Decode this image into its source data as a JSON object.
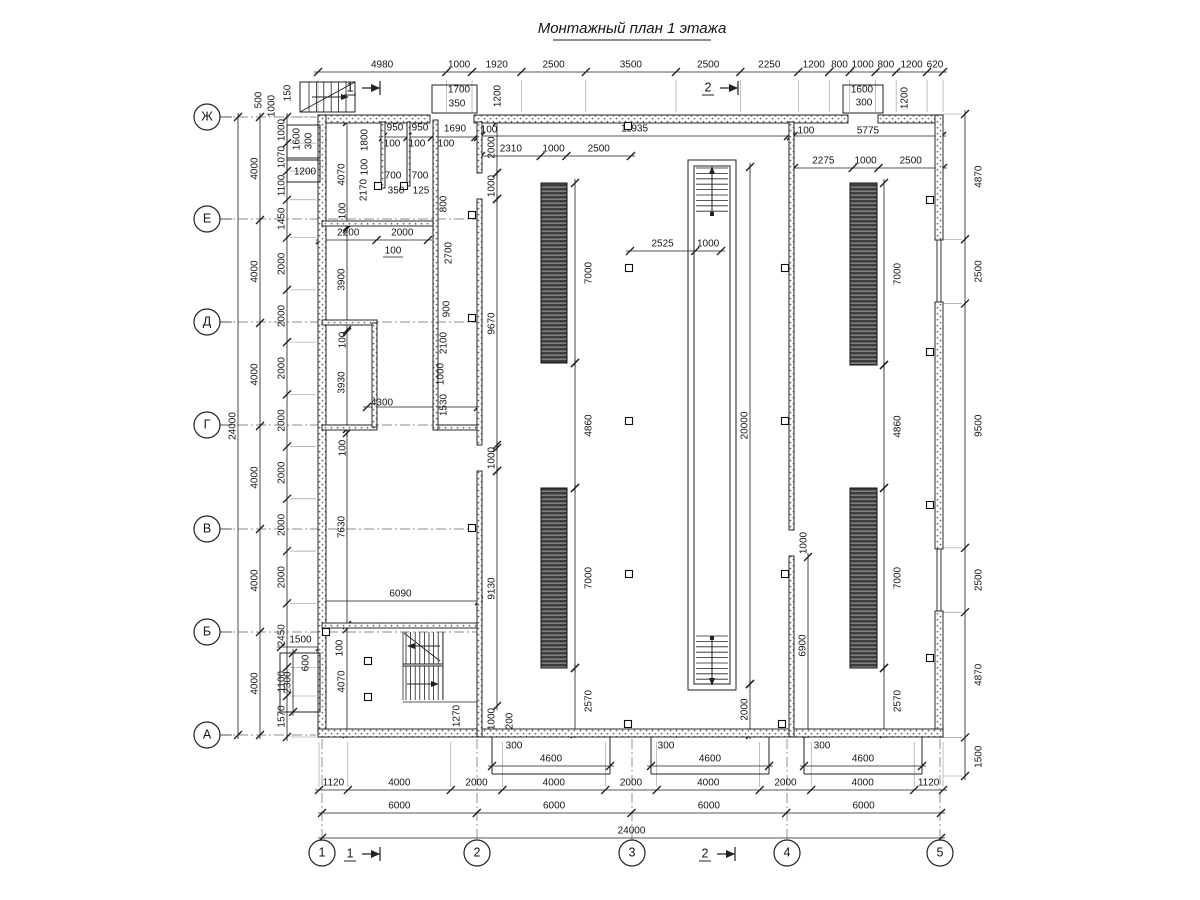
{
  "title": {
    "text": "Монтажный план 1 этажа"
  },
  "colors": {
    "line": "#1c1c1c",
    "dim": "#151515",
    "ext": "#8a8a8a",
    "axisline": "#666666",
    "rack_bg": "#3d3d3d",
    "rack_stripe": "#9a9a9a",
    "stipple": "#6e6e6e"
  },
  "axis": {
    "row_cx": 207,
    "col_cy": 853,
    "r": 13,
    "rows": [
      [
        "Ж",
        117
      ],
      [
        "Е",
        219
      ],
      [
        "Д",
        322
      ],
      [
        "Г",
        425
      ],
      [
        "В",
        529
      ],
      [
        "Б",
        632
      ],
      [
        "А",
        735
      ]
    ],
    "cols": [
      [
        "1",
        322
      ],
      [
        "2",
        477
      ],
      [
        "3",
        632
      ],
      [
        "4",
        787
      ],
      [
        "5",
        940
      ]
    ]
  },
  "section_marks": [
    [
      "1",
      350,
      80
    ],
    [
      "2",
      708,
      80
    ],
    [
      "1",
      350,
      846
    ],
    [
      "2",
      705,
      846
    ]
  ],
  "chains": [
    {
      "o": "h",
      "line": 72,
      "a0": 318,
      "end": 943,
      "v": [
        4980,
        1000,
        1920,
        2500,
        3500,
        2500,
        2250,
        1200,
        800,
        1000,
        800,
        1200,
        620
      ],
      "ext": [
        80,
        112
      ]
    },
    {
      "o": "v",
      "line": 287,
      "a0": 117,
      "end": 737,
      "v": [
        1000,
        1070,
        1100,
        1450,
        2000,
        2000,
        2000,
        2000,
        2000,
        2000,
        2000,
        2450,
        1100,
        1570
      ],
      "ext": [
        290,
        316
      ]
    },
    {
      "o": "v",
      "line": 260,
      "a0": 117,
      "end": 735,
      "v": [
        4000,
        4000,
        4000,
        4000,
        4000,
        4000
      ]
    },
    {
      "o": "v",
      "line": 238,
      "a0": 117,
      "end": 735,
      "v": [
        24000
      ]
    },
    {
      "o": "v",
      "line": 965,
      "a0": 114,
      "end": 776,
      "v": [
        4870,
        2500,
        9500,
        2500,
        4870,
        1500
      ],
      "ext": [
        943,
        962
      ],
      "ls": 1
    },
    {
      "o": "h",
      "line": 790,
      "a0": 319,
      "end": 943,
      "v": [
        1120,
        4000,
        2000,
        4000,
        2000,
        4000,
        2000,
        4000,
        1120
      ],
      "ext": [
        742,
        787
      ]
    },
    {
      "o": "h",
      "line": 813,
      "a0": 322,
      "end": 941,
      "v": [
        6000,
        6000,
        6000,
        6000
      ]
    },
    {
      "o": "h",
      "line": 838,
      "a0": 322,
      "end": 941,
      "v": [
        24000
      ]
    },
    {
      "o": "h",
      "line": 136,
      "a0": 481,
      "end": 788,
      "v": [
        11935
      ]
    },
    {
      "o": "h",
      "line": 136,
      "a0": 791,
      "end": 942,
      "v": [
        100,
        5775
      ],
      "nl": 1
    },
    {
      "o": "h",
      "line": 137,
      "a0": 383,
      "end": 478,
      "v": [
        950,
        950,
        1690,
        100
      ],
      "nl": 1
    },
    {
      "o": "h",
      "line": 156,
      "a0": 481,
      "end": 631,
      "v": [
        2310,
        1000,
        2500
      ]
    },
    {
      "o": "h",
      "line": 168,
      "a0": 794,
      "end": 943,
      "v": [
        2275,
        1000,
        2500
      ]
    },
    {
      "o": "h",
      "line": 251,
      "a0": 630,
      "end": 721,
      "v": [
        2525,
        1000
      ]
    },
    {
      "o": "h",
      "line": 240,
      "a0": 320,
      "end": 428,
      "v": [
        2200,
        2000
      ]
    },
    {
      "o": "h",
      "line": 601,
      "a0": 322,
      "end": 479,
      "v": [
        6090
      ]
    },
    {
      "o": "h",
      "line": 407,
      "a0": 367,
      "end": 478,
      "v": [
        4300
      ],
      "nl": 1
    },
    {
      "o": "h",
      "line": 647,
      "a0": 281,
      "end": 320,
      "v": [
        1500
      ]
    },
    {
      "o": "v",
      "line": 293,
      "a0": 653,
      "end": 712,
      "v": [
        2300
      ]
    },
    {
      "o": "v",
      "line": 347,
      "a0": 122,
      "end": 227,
      "v": [
        4070
      ]
    },
    {
      "o": "v",
      "line": 347,
      "a0": 229,
      "end": 330,
      "v": [
        3900
      ]
    },
    {
      "o": "v",
      "line": 347,
      "a0": 332,
      "end": 433,
      "v": [
        3930
      ]
    },
    {
      "o": "v",
      "line": 347,
      "a0": 429,
      "end": 625,
      "v": [
        7630
      ]
    },
    {
      "o": "v",
      "line": 347,
      "a0": 629,
      "end": 734,
      "v": [
        4070
      ]
    },
    {
      "o": "v",
      "line": 497,
      "a0": 122,
      "end": 173,
      "v": [
        2000
      ]
    },
    {
      "o": "v",
      "line": 497,
      "a0": 173,
      "end": 199,
      "v": [
        1000
      ]
    },
    {
      "o": "v",
      "line": 497,
      "a0": 199,
      "end": 448,
      "v": [
        9670
      ]
    },
    {
      "o": "v",
      "line": 497,
      "a0": 445,
      "end": 471,
      "v": [
        1000
      ]
    },
    {
      "o": "v",
      "line": 497,
      "a0": 471,
      "end": 706,
      "v": [
        9130
      ]
    },
    {
      "o": "v",
      "line": 750,
      "a0": 167,
      "end": 684,
      "v": [
        20000
      ]
    },
    {
      "o": "v",
      "line": 750,
      "a0": 684,
      "end": 735,
      "v": [
        2000
      ]
    },
    {
      "o": "v",
      "line": 808,
      "a0": 557,
      "end": 734,
      "v": [
        6900
      ]
    },
    {
      "o": "v",
      "line": 575,
      "a0": 183,
      "end": 363,
      "v": [
        7000
      ],
      "ls": 1
    },
    {
      "o": "v",
      "line": 575,
      "a0": 363,
      "end": 488,
      "v": [
        4860
      ],
      "ls": 1
    },
    {
      "o": "v",
      "line": 575,
      "a0": 488,
      "end": 668,
      "v": [
        7000
      ],
      "ls": 1
    },
    {
      "o": "v",
      "line": 575,
      "a0": 668,
      "end": 734,
      "v": [
        2570
      ],
      "ls": 1
    },
    {
      "o": "v",
      "line": 884,
      "a0": 183,
      "end": 365,
      "v": [
        7000
      ],
      "ls": 1
    },
    {
      "o": "v",
      "line": 884,
      "a0": 365,
      "end": 488,
      "v": [
        4860
      ],
      "ls": 1
    },
    {
      "o": "v",
      "line": 884,
      "a0": 488,
      "end": 668,
      "v": [
        7000
      ],
      "ls": 1
    },
    {
      "o": "v",
      "line": 884,
      "a0": 668,
      "end": 734,
      "v": [
        2570
      ],
      "ls": 1
    },
    {
      "o": "h",
      "line": 766,
      "a0": 492,
      "end": 610,
      "v": [
        4600
      ]
    },
    {
      "o": "h",
      "line": 766,
      "a0": 651,
      "end": 769,
      "v": [
        4600
      ]
    },
    {
      "o": "h",
      "line": 766,
      "a0": 804,
      "end": 922,
      "v": [
        4600
      ]
    }
  ],
  "labels": [
    [
      "500",
      258,
      100,
      1
    ],
    [
      "1000",
      271,
      106,
      1
    ],
    [
      "150",
      287,
      93,
      1
    ],
    [
      "1700",
      459,
      89,
      0
    ],
    [
      "350",
      457,
      103,
      0
    ],
    [
      "1200",
      497,
      96,
      1
    ],
    [
      "1600",
      862,
      89,
      0
    ],
    [
      "300",
      864,
      102,
      0
    ],
    [
      "1200",
      904,
      98,
      1
    ],
    [
      "950",
      395,
      127,
      0
    ],
    [
      "950",
      420,
      127,
      0
    ],
    [
      "1690",
      455,
      128,
      0
    ],
    [
      "100",
      489,
      129,
      0
    ],
    [
      "100",
      392,
      143,
      0
    ],
    [
      "100",
      417,
      143,
      0
    ],
    [
      "100",
      446,
      143,
      0
    ],
    [
      "1600",
      296,
      139,
      1
    ],
    [
      "300",
      308,
      141,
      1
    ],
    [
      "1200",
      305,
      171,
      0
    ],
    [
      "1800",
      364,
      140,
      1
    ],
    [
      "100",
      364,
      167,
      1
    ],
    [
      "2170",
      363,
      190,
      1
    ],
    [
      "100",
      342,
      211,
      1
    ],
    [
      "700",
      393,
      175,
      0
    ],
    [
      "700",
      420,
      175,
      0
    ],
    [
      "350",
      396,
      190,
      0
    ],
    [
      "125",
      421,
      190,
      0
    ],
    [
      "800",
      443,
      204,
      1
    ],
    [
      "2700",
      448,
      253,
      1
    ],
    [
      "100",
      393,
      250,
      0,
      1
    ],
    [
      "900",
      446,
      309,
      1
    ],
    [
      "2100",
      443,
      343,
      1
    ],
    [
      "1000",
      440,
      374,
      1
    ],
    [
      "1530",
      443,
      405,
      1
    ],
    [
      "100",
      342,
      340,
      1
    ],
    [
      "100",
      342,
      448,
      1
    ],
    [
      "100",
      339,
      648,
      1
    ],
    [
      "600",
      305,
      663,
      1
    ],
    [
      "4300",
      382,
      402,
      0
    ],
    [
      "1270",
      456,
      716,
      1
    ],
    [
      "1000",
      491,
      719,
      1
    ],
    [
      "200",
      509,
      721,
      1
    ],
    [
      "300",
      514,
      745,
      0
    ],
    [
      "300",
      666,
      745,
      0
    ],
    [
      "300",
      822,
      745,
      0
    ],
    [
      "100",
      806,
      130,
      0
    ],
    [
      "5775",
      868,
      130,
      0
    ],
    [
      "1000",
      803,
      543,
      1
    ]
  ],
  "walls": [
    [
      318,
      115,
      112,
      8
    ],
    [
      474,
      115,
      374,
      8
    ],
    [
      878,
      115,
      65,
      8
    ],
    [
      318,
      115,
      8,
      622
    ],
    [
      935,
      115,
      8,
      125
    ],
    [
      935,
      302,
      8,
      247
    ],
    [
      935,
      611,
      8,
      126
    ],
    [
      318,
      729,
      625,
      8
    ],
    [
      322,
      221,
      116,
      5
    ],
    [
      322,
      320,
      55,
      5
    ],
    [
      322,
      425,
      55,
      5
    ],
    [
      437,
      425,
      40,
      5
    ],
    [
      372,
      323,
      5,
      104
    ],
    [
      433,
      120,
      5,
      310
    ],
    [
      381,
      122,
      4,
      66
    ],
    [
      407,
      122,
      3,
      64
    ],
    [
      477,
      122,
      5,
      51
    ],
    [
      477,
      199,
      5,
      246
    ],
    [
      477,
      471,
      5,
      266
    ],
    [
      322,
      623,
      155,
      5
    ],
    [
      789,
      122,
      5,
      408
    ],
    [
      789,
      556,
      5,
      181
    ]
  ],
  "windows": [
    [
      937,
      240,
      937,
      302
    ],
    [
      941,
      240,
      941,
      302
    ],
    [
      937,
      549,
      937,
      611
    ],
    [
      941,
      549,
      941,
      611
    ]
  ],
  "outlines": [
    [
      688,
      160,
      48,
      530
    ],
    [
      694,
      166,
      36,
      518
    ],
    [
      432,
      85,
      45,
      28
    ],
    [
      843,
      85,
      40,
      28
    ],
    [
      287,
      125,
      33,
      33
    ],
    [
      287,
      160,
      33,
      22
    ],
    [
      280,
      653,
      40,
      59
    ],
    [
      300,
      82,
      55,
      30
    ]
  ],
  "racks": [
    [
      541,
      183,
      26,
      180
    ],
    [
      541,
      488,
      26,
      180
    ],
    [
      850,
      183,
      27,
      182
    ],
    [
      850,
      488,
      27,
      180
    ]
  ],
  "ladders": [
    {
      "cx": 712,
      "x0": 696,
      "x1": 728,
      "y0": 168,
      "y1": 216,
      "dir": "up"
    },
    {
      "cx": 712,
      "x0": 696,
      "x1": 728,
      "y0": 636,
      "y1": 684,
      "dir": "down"
    }
  ],
  "stairs_bottom": {
    "x0": 403,
    "x1": 443,
    "y0": 632,
    "mid": 665,
    "y1": 700
  },
  "stairs_top": {
    "x0": 300,
    "x1": 355,
    "y0": 82,
    "y1": 112
  },
  "docks": [
    [
      492,
      610
    ],
    [
      651,
      769
    ],
    [
      804,
      922
    ]
  ],
  "columns": [
    [
      629,
      268
    ],
    [
      629,
      421
    ],
    [
      629,
      574
    ],
    [
      785,
      268
    ],
    [
      785,
      421
    ],
    [
      785,
      574
    ],
    [
      930,
      200
    ],
    [
      930,
      352
    ],
    [
      930,
      505
    ],
    [
      930,
      658
    ],
    [
      628,
      126
    ],
    [
      628,
      724
    ],
    [
      782,
      724
    ],
    [
      472,
      215
    ],
    [
      472,
      318
    ],
    [
      472,
      528
    ],
    [
      326,
      632
    ],
    [
      368,
      661
    ],
    [
      368,
      697
    ],
    [
      378,
      186
    ],
    [
      404,
      186
    ]
  ],
  "misc_lines": [
    [
      403,
      632,
      403,
      700
    ],
    [
      443,
      632,
      443,
      700
    ],
    [
      403,
      702,
      477,
      702
    ]
  ]
}
